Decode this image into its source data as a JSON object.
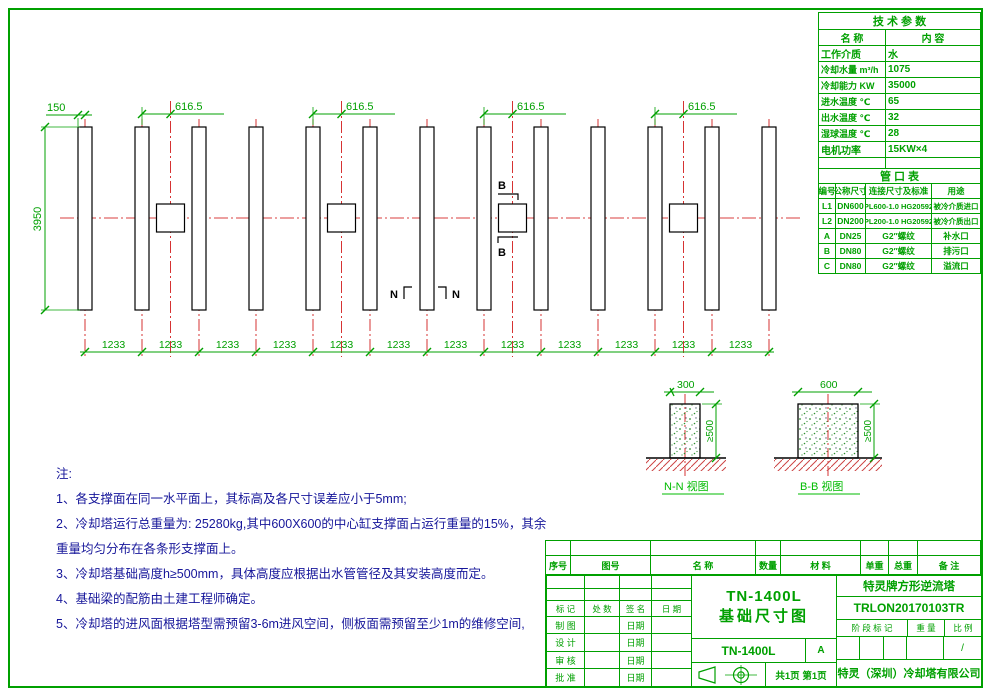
{
  "sheet": {
    "plan": {
      "dim_edge": "150",
      "dim_bay": "616.5",
      "dim_height": "3950",
      "dim_spacing": "1233",
      "section_b": "B",
      "section_n": "N"
    },
    "details": {
      "a_width": "300",
      "b_width": "600",
      "height": "≥500",
      "a_caption": "N-N 视图",
      "b_caption": "B-B 视图"
    },
    "notes": {
      "title": "注:",
      "items": [
        "1、各支撑面在同一水平面上，其标高及各尺寸误差应小于5mm;",
        "2、冷却塔运行总重量为: 25280kg,其中600X600的中心缸支撑面占运行重量的15%，其余重量均匀分布在各条形支撑面上。",
        "3、冷却塔基础高度h≥500mm，具体高度应根据出水管管径及其安装高度而定。",
        "4、基础梁的配筋由土建工程师确定。",
        "5、冷却塔的进风面根据塔型需预留3-6m进风空间，侧板面需预留至少1m的维修空间,"
      ]
    },
    "tech": {
      "title": "技 术 参 数",
      "name_h": "名    称",
      "value_h": "内    容",
      "rows": [
        [
          "工作介质",
          "水"
        ],
        [
          "冷却水量  m³/h",
          "1075"
        ],
        [
          "冷却能力  KW",
          "35000"
        ],
        [
          "进水温度  ℃",
          "65"
        ],
        [
          "出水温度  ℃",
          "32"
        ],
        [
          "湿球温度  ℃",
          "28"
        ],
        [
          "电机功率",
          "15KW×4"
        ],
        [
          "",
          ""
        ]
      ]
    },
    "pipes": {
      "title": "管 口 表",
      "headers": [
        "编号",
        "公称尺寸",
        "连接尺寸及标准",
        "用途"
      ],
      "rows": [
        [
          "L1",
          "DN600",
          "PL600-1.0 HG20592",
          "被冷介质进口"
        ],
        [
          "L2",
          "DN200",
          "PL200-1.0 HG20592",
          "被冷介质出口"
        ],
        [
          "A",
          "DN25",
          "G2″螺纹",
          "补水口"
        ],
        [
          "B",
          "DN80",
          "G2″螺纹",
          "排污口"
        ],
        [
          "C",
          "DN80",
          "G2″螺纹",
          "溢流口"
        ]
      ]
    },
    "parts_headers": [
      "序号",
      "图号",
      "名  称",
      "数量",
      "材  料",
      "单重",
      "总重",
      "备  注"
    ],
    "tb": {
      "sig_headers": [
        "标 记",
        "处 数",
        "签  名",
        "日  期"
      ],
      "date_label": "日期",
      "sig_rows": [
        "制 图",
        "设 计",
        "审 核",
        "批 准"
      ],
      "model": "TN-1400L",
      "title2": "基础尺寸图",
      "drawing_no": "TN-1400L",
      "rev": "A",
      "pages": "共1页 第1页",
      "product": "特灵牌方形逆流塔",
      "code": "TRLON20170103TR",
      "stage": "阶 段 标 记",
      "weight": "重 量",
      "scale": "比 例",
      "scale_v": "/",
      "company": "特灵（深圳）冷却塔有限公司"
    }
  }
}
